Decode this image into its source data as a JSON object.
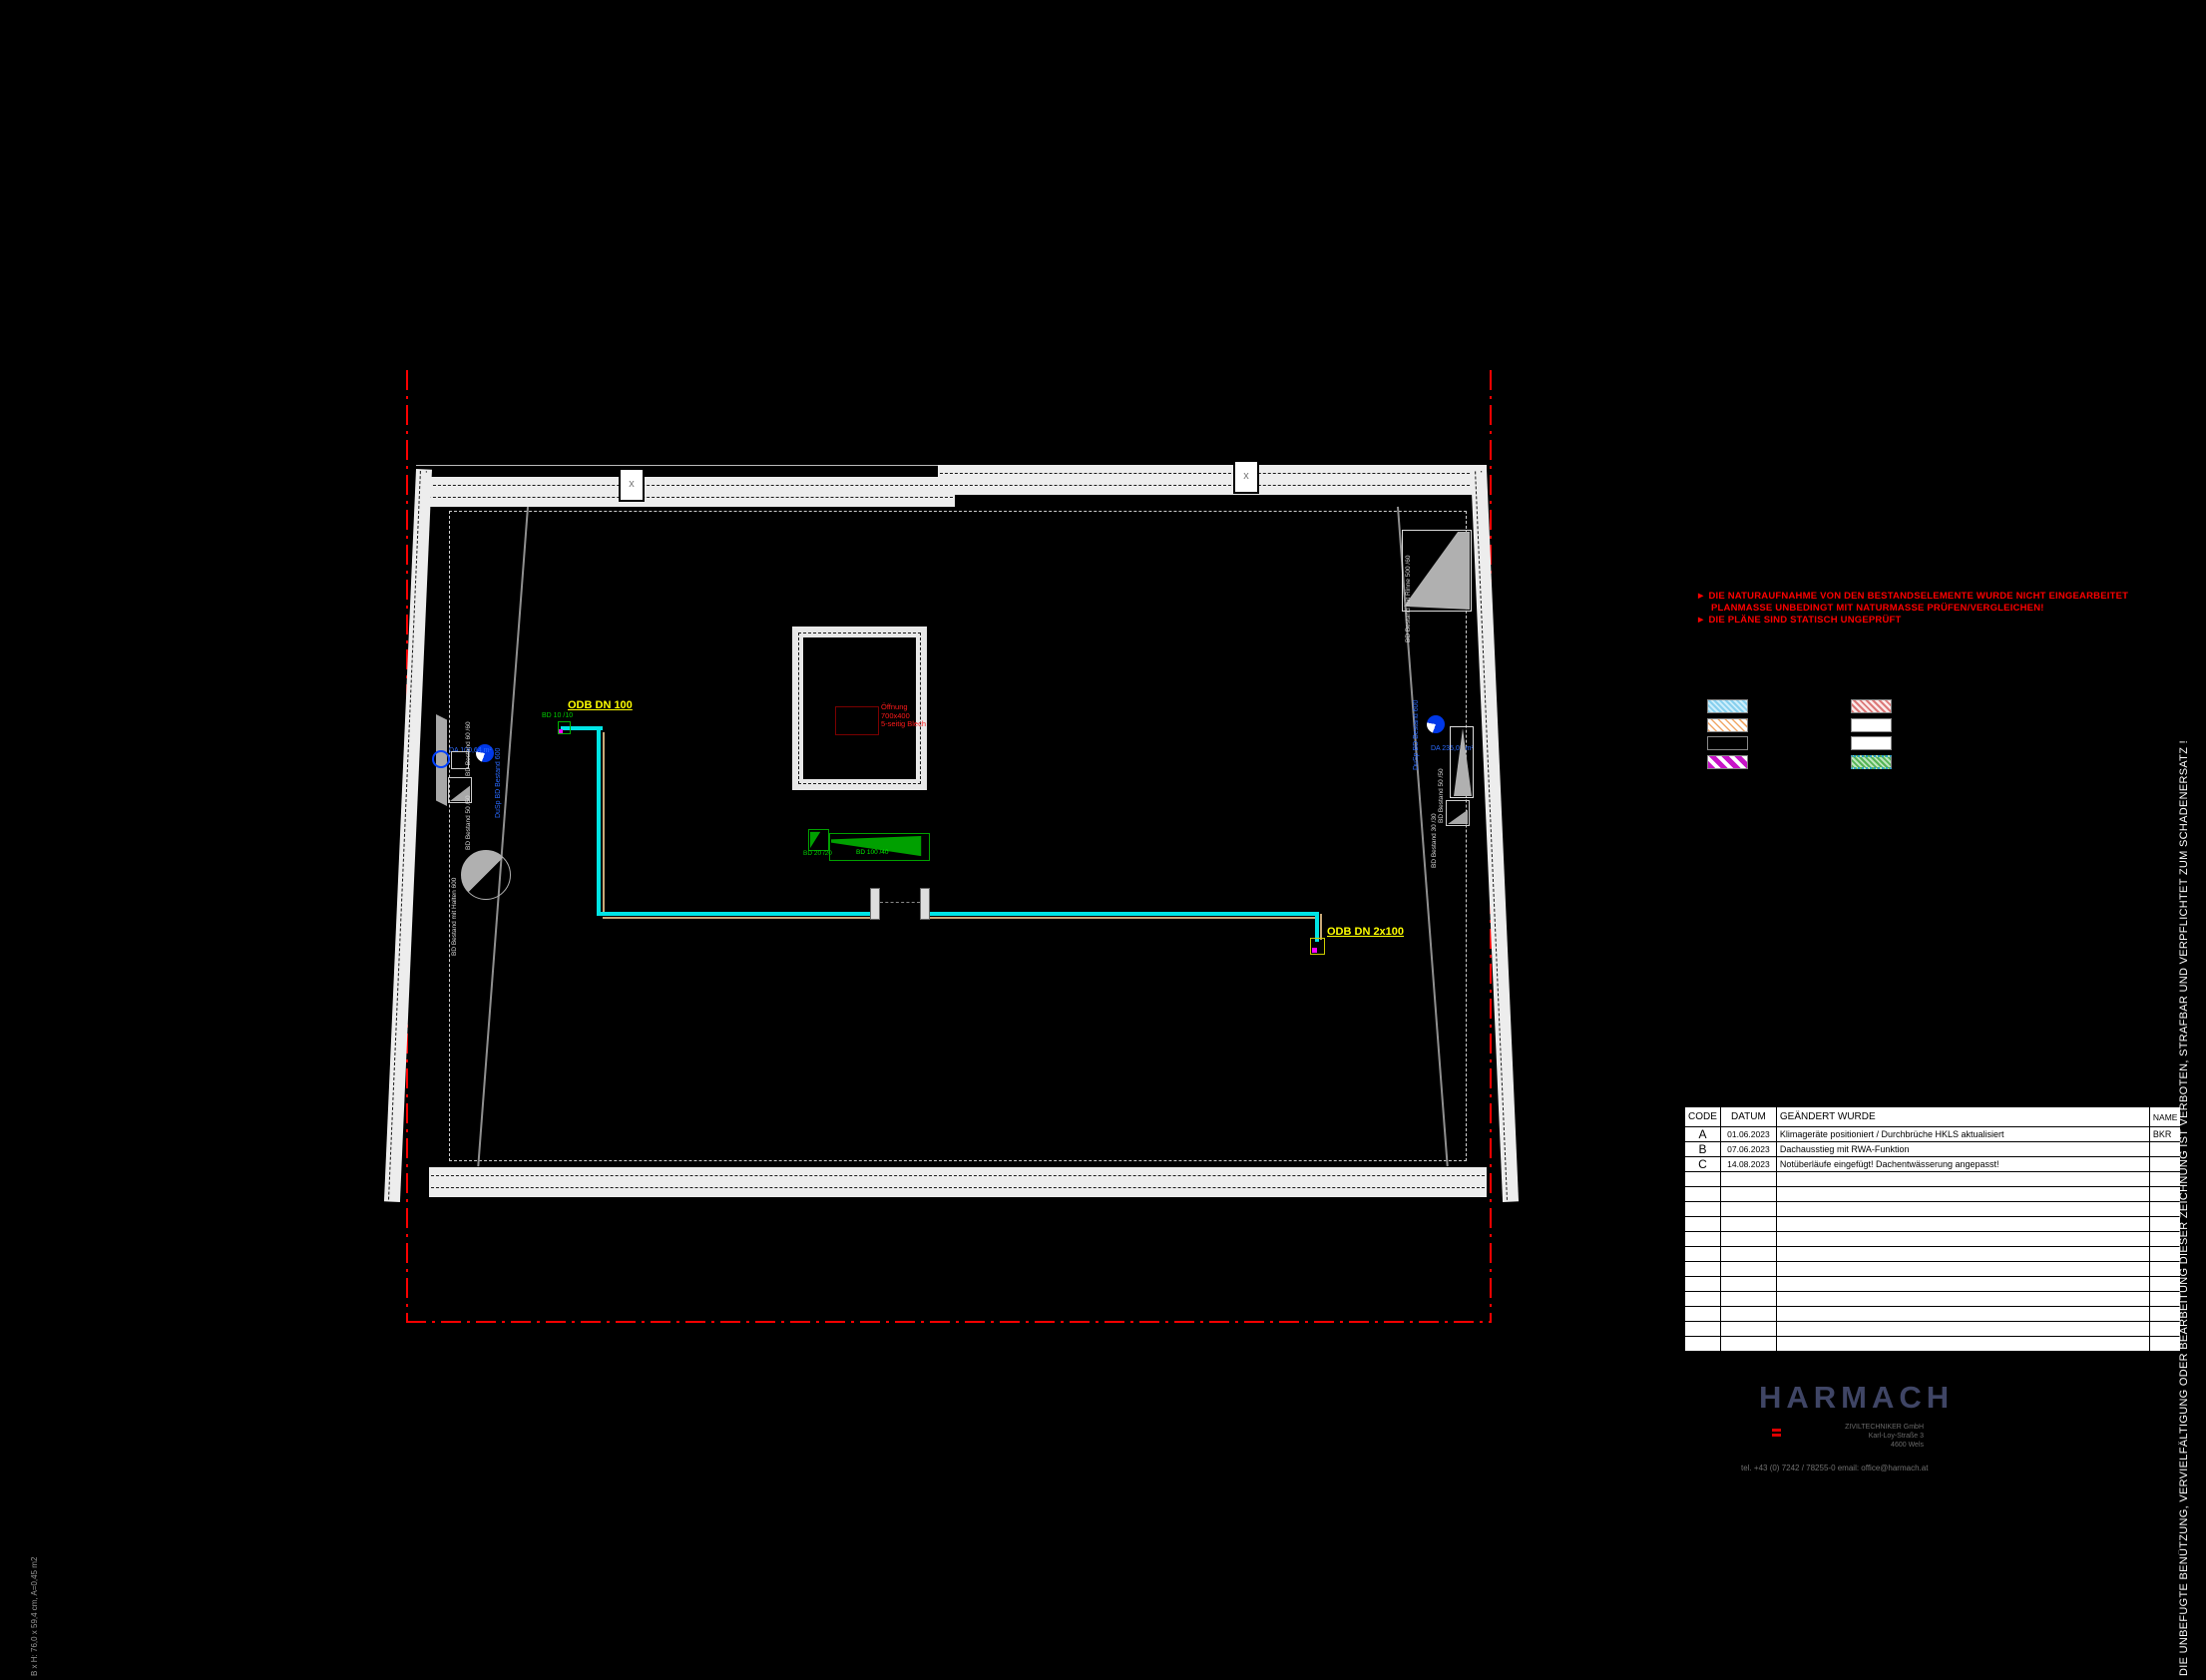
{
  "sheet": {
    "background": "#000000",
    "copyright_vertical": "DIE UNBEFUGTE BENÜTZUNG, VERVIELFÄLTIGUNG ODER BEARBEITUNG DIESER ZEICHNUNG IST VERBOTEN, STRAFBAR UND VERPFLICHTET ZUM SCHADENERSATZ !",
    "format_note": "B x H: 76,0 x 59,4 cm, A=0,45 m2"
  },
  "warnings": {
    "color": "#ff0000",
    "arrow": "►",
    "line1": "DIE NATURAUFNAHME VON DEN BESTANDSELEMENTE WURDE NICHT EINGEARBEITET",
    "line2": "PLANMASSE UNBEDINGT MIT NATURMASSE PRÜFEN/VERGLEICHEN!",
    "line3": "DIE PLÄNE SIND STATISCH UNGEPRÜFT"
  },
  "plan": {
    "colors": {
      "pipe_cyan": "#00e5e5",
      "pipe_tan": "#c8a878",
      "drain_blue": "#0038e8",
      "wedge_green": "#00a000",
      "label_yellow": "#ffff00",
      "boundary_red": "#ff0000",
      "wall_white": "#ededed"
    },
    "labels": {
      "odb_dn100": "ODB DN 100",
      "odb_dn2x100": "ODB DN 2x100",
      "bd_10_10": "BD 10 /10",
      "bd_20_20": "BD 20 /20",
      "bd_100_40": "BD 100 /40",
      "opening_l1": "Öffnung",
      "opening_l2": "700x400",
      "opening_l3": "5-seitig Blech",
      "drain_left_area": "DA 100,64 m²",
      "drain_left_pipe": "DuSp BD Bestand 600",
      "drain_right_area": "DA 235,02 m²",
      "drain_right_pipe": "DuSp BD Bestand 600",
      "bestand_60": "BD Bestand 60 /60",
      "bestand_50_left": "BD Bestand 50 /50",
      "bestand_50_right": "BD Bestand 50 /50",
      "bestand_30": "BD Bestand 30 /30",
      "bestand_halten": "BD Bestand mit Halten 600",
      "bestand_rinne_top": "BD Bestand mit Rinne 500 /60",
      "bestand_rinne_bottom": "BD Bestand mit Rinne 500 /60"
    }
  },
  "legend": {
    "left_column": [
      {
        "name": "cyan-hatch",
        "color": "#86cfee"
      },
      {
        "name": "orange-hatch",
        "color": "#f0a868"
      },
      {
        "name": "red-crosshatch",
        "color": "#e08c8c"
      },
      {
        "name": "magenta-stripe",
        "color": "#c814c8"
      }
    ],
    "right_column": [
      {
        "name": "pink-hatch",
        "color": "#dc7878"
      },
      {
        "name": "zigzag-white",
        "color": "#909090"
      },
      {
        "name": "zigzag-white-2",
        "color": "#909090"
      },
      {
        "name": "green-hatch-dotted",
        "color": "#55b455"
      }
    ]
  },
  "revision_table": {
    "headers": {
      "code": "CODE",
      "datum": "DATUM",
      "changed": "GEÄNDERT WURDE",
      "name": "NAME"
    },
    "rows": [
      {
        "code": "A",
        "datum": "01.06.2023",
        "text": "Klimageräte positioniert / Durchbrüche HKLS aktualisiert",
        "name": "BKR"
      },
      {
        "code": "B",
        "datum": "07.06.2023",
        "text": "Dachausstieg mit RWA-Funktion",
        "name": ""
      },
      {
        "code": "C",
        "datum": "14.08.2023",
        "text": "Notüberläufe eingefügt! Dachentwässerung angepasst!",
        "name": ""
      }
    ],
    "empty_row_count": 12
  },
  "title_block": {
    "logo_text": "HARMACH",
    "logo_color": "#3f4565",
    "company_line1": "ZIVILTECHNIKER GmbH",
    "company_line2": "Karl-Loy-Straße 3",
    "company_line3": "4600 Wels",
    "contact": "tel. +43 (0) 7242 / 78255-0      email:  office@harmach.at"
  }
}
